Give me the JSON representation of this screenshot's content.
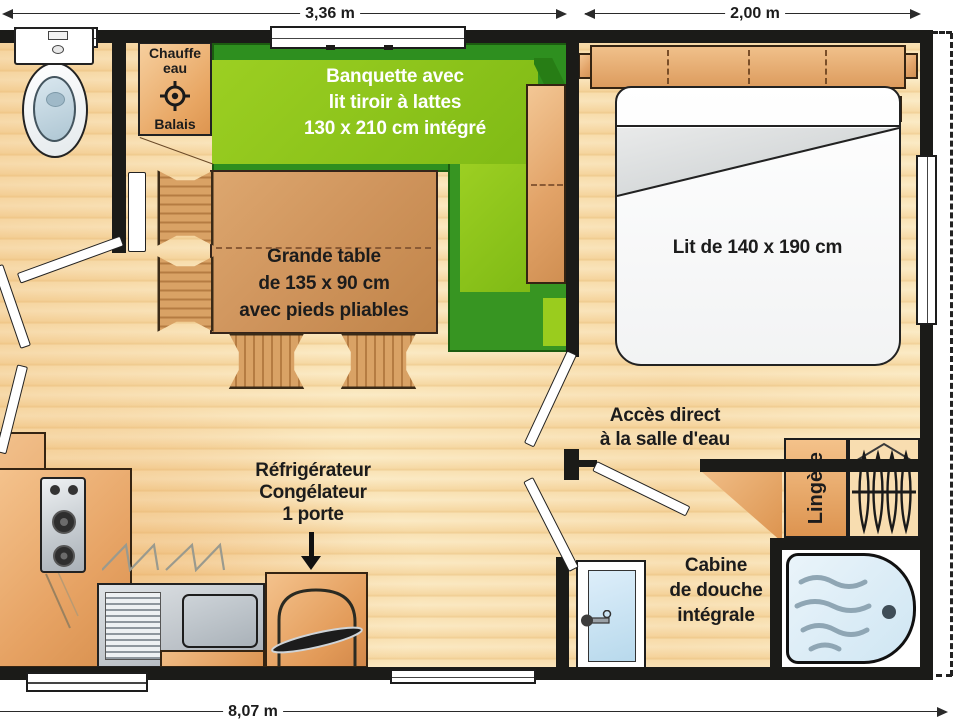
{
  "dimensions": {
    "living_width": "3,36 m",
    "bedroom_width": "2,00 m",
    "total_length": "8,07 m"
  },
  "rooms": {
    "utility_closet": {
      "line1": "Chauffe",
      "line2": "eau",
      "line3": "Balais"
    },
    "banquette": {
      "line1": "Banquette avec",
      "line2": "lit tiroir à lattes",
      "line3": "130 x 210 cm intégré"
    },
    "table": {
      "line1": "Grande table",
      "line2": "de 135 x 90 cm",
      "line3": "avec pieds pliables"
    },
    "bed_label": "Lit de 140 x 190 cm",
    "bathroom_access": {
      "line1": "Accès direct",
      "line2": "à la salle d'eau"
    },
    "fridge": {
      "line1": "Réfrigérateur",
      "line2": "Congélateur",
      "line3": "1 porte"
    },
    "linen_cabinet": "Lingère",
    "shower": {
      "line1": "Cabine",
      "line2": "de douche",
      "line3": "intégrale"
    }
  },
  "colors": {
    "wall": "#1b1b18",
    "banquette_dark": "#2e8f1f",
    "banquette_light": "#8cc21c",
    "wood_accent": "#e2a368",
    "floor": "#f6d9a4",
    "shower_tray": "#cfe6f3"
  }
}
